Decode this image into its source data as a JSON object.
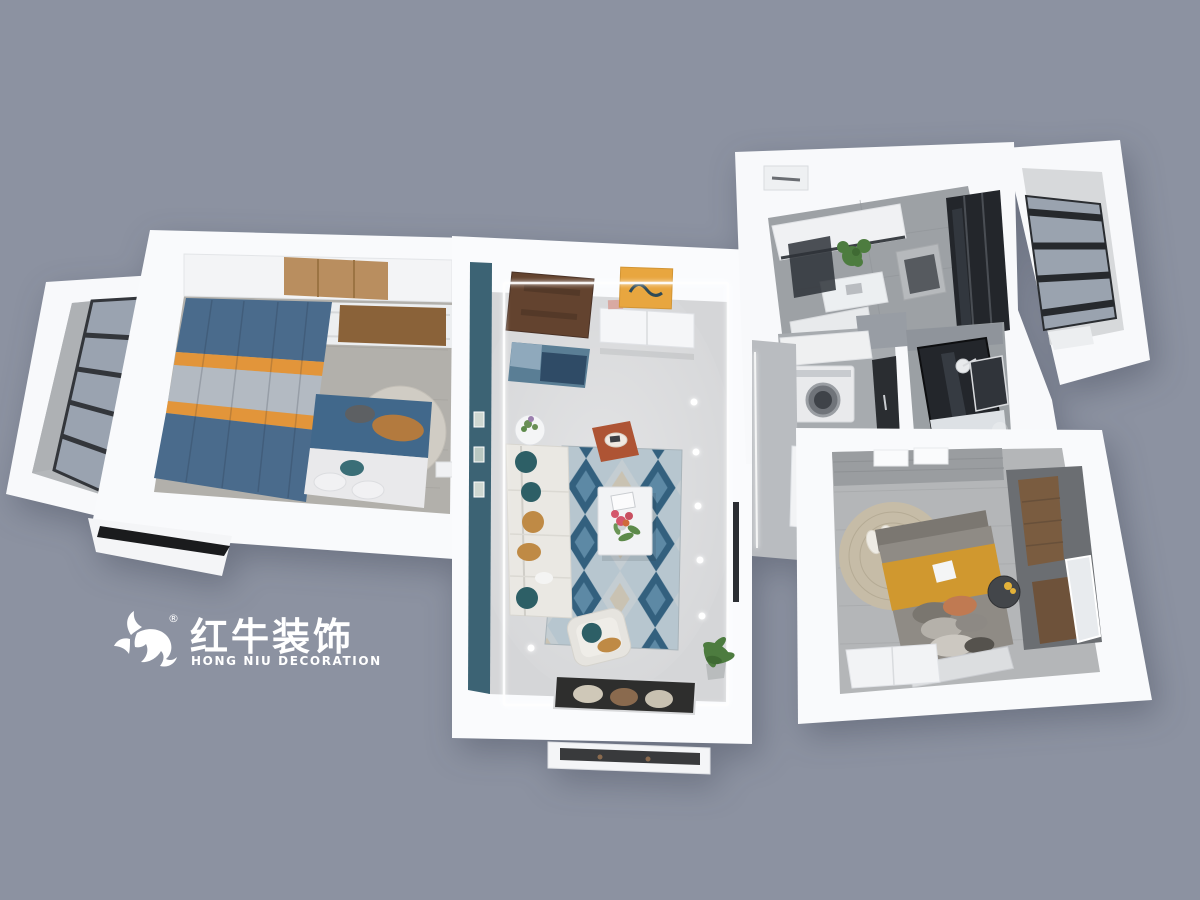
{
  "canvas": {
    "width": 1200,
    "height": 900
  },
  "scene_type": "3d-floorplan-top-view-render",
  "watermark": {
    "brand_cn": "红牛装饰",
    "brand_en": "HONG NIU DECORATION",
    "registered_mark": "®",
    "color": "#ffffff",
    "logo_icon": "bull-swoosh-mark"
  },
  "rooms": [
    "left-balcony",
    "master-bedroom",
    "entry",
    "living-dining-room",
    "hallway",
    "kitchen",
    "north-balcony",
    "laundry",
    "bathroom",
    "second-bedroom",
    "entry-porch"
  ],
  "palette": {
    "bg": "#8c92a1",
    "wall": "#f7f8fa",
    "floor_marble": "#d5d6d8",
    "floor_wood_gray": "#b2b0ab",
    "floor_tile": "#9da1a5",
    "balcony_floor": "#b4b7ba",
    "accent_teal": "#3c6374",
    "glass_blue": "#9aa3b0",
    "frame_dark": "#33363b",
    "glass_dark": "#23262b",
    "door_brown": "#63432f",
    "mat_blue": "#5a7e95",
    "painting_orange": "#e8a63f",
    "sofa_white": "#eae8e3",
    "pillow_teal": "#2d5f66",
    "pillow_mustard": "#bf8a45",
    "ottoman_rust": "#ae5434",
    "rug_blue_dark": "#33607e",
    "rug_blue_mid": "#5d89a5",
    "rug_blue_light": "#b7c6cf",
    "rug_gray": "#c4cdd2",
    "rug_beige": "#c9c2b2",
    "bed_blue": "#41688b",
    "curtain_blue": "#4a6b8c",
    "curtain_orange": "#e2953a",
    "curtain_gray": "#b3bac2",
    "headboard_gray": "#d0ccc4",
    "wood": "#8a6239",
    "wood_light": "#b98e5f",
    "wood_dark": "#7a5c40",
    "plant_green": "#4d7c3f",
    "bed2_gray": "#8f8b85",
    "blanket_mustard": "#d0982f",
    "rug_tan": "#c6bca7",
    "dark_panel": "#6b6e72",
    "led_white": "#ffffff"
  }
}
